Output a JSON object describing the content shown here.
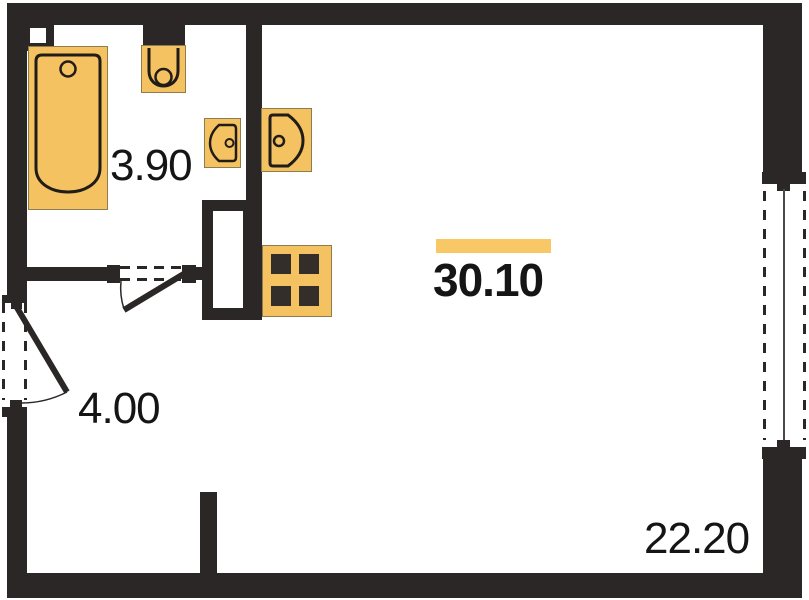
{
  "rooms": {
    "bathroom": {
      "area": "3.90"
    },
    "hallway": {
      "area": "4.00"
    },
    "main": {
      "area": "30.10"
    },
    "main_far": {
      "area": "22.20"
    }
  },
  "fixtures": [
    "bathtub",
    "toilet",
    "bathroom-sink",
    "kitchen-sink",
    "stove",
    "duct-shaft",
    "entry-door",
    "bathroom-door",
    "window"
  ],
  "colors": {
    "wall": "#2b2726",
    "fixture-fill": "#f5c262",
    "fixture-edge": "#8f7c4e",
    "stroke": "#201c18",
    "burner": "#332e2a",
    "accent": "#f8c766",
    "text": "#151515",
    "glass": "#4a4a4a"
  }
}
